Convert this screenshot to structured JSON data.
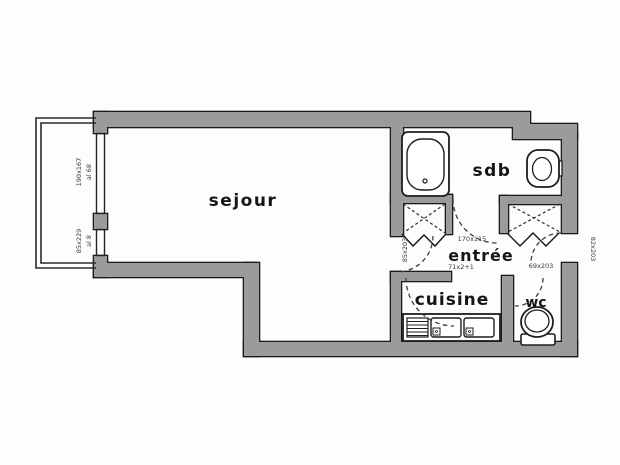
{
  "plan": {
    "type": "apartment-floor-plan",
    "rooms": {
      "sejour": "sejour",
      "sdb": "sdb",
      "entree": "entrée",
      "cuisine": "cuisine",
      "wc": "wc"
    },
    "annotations": {
      "balcony_window_dim": "190x167",
      "balcony_window_sill": "al 68",
      "balcony_door_dim": "85x229",
      "balcony_door_sill": "al 8",
      "sejour_door_dim": "85x203",
      "entree_dim_1": "170x115",
      "entree_dim_2": "71x2+1",
      "wc_door_dim": "69x203",
      "entrance_door_dim": "82x203"
    },
    "colors": {
      "background": "#fdfdfd",
      "wall_fill": "#9b9b9b",
      "wall_outline": "#1b1b1b",
      "fixture_stroke": "#1d1d1d",
      "door_arc": "#3c3c3c",
      "label_text": "#141414",
      "annotation_text": "#3a3a3a"
    }
  }
}
